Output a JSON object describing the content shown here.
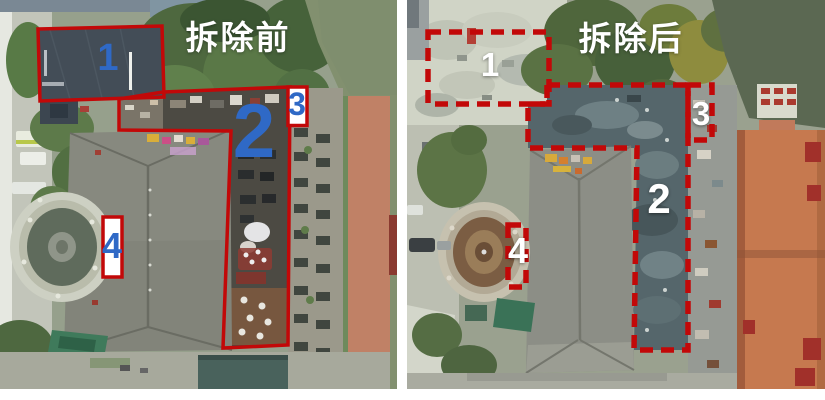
{
  "figure": {
    "panels": [
      {
        "id": "before",
        "title": "拆除前",
        "line_style": "solid",
        "number_color": "#2F69C6",
        "zone_labels": [
          "1",
          "2",
          "3",
          "4"
        ]
      },
      {
        "id": "after",
        "title": "拆除后",
        "line_style": "dashed",
        "number_color": "#FFFFFF",
        "zone_labels": [
          "1",
          "2",
          "3",
          "4"
        ]
      }
    ],
    "colors": {
      "annotation_red": "#C20808",
      "title_white": "#FFFFFF",
      "number_blue": "#2F69C6"
    }
  }
}
